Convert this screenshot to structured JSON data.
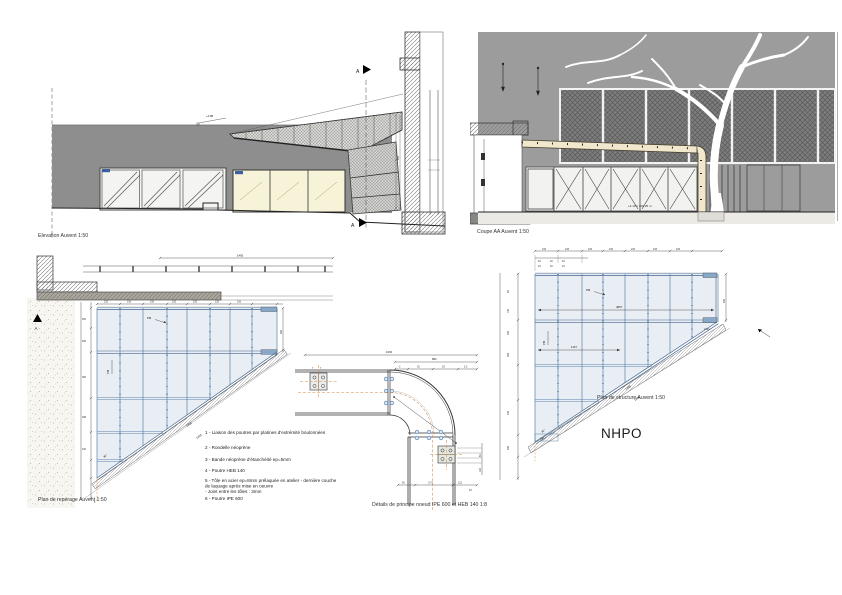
{
  "colors": {
    "facade_gray": "#8e8e8e",
    "section_gray": "#9c9c9c",
    "dark_panel": "#7d7d7d",
    "window_yellow": "#f7f3d9",
    "panel_blue": "#e9eef4",
    "beam_blue": "#5b82a8",
    "cap_blue": "#89a8c8",
    "beam_cream": "#f0e7cd",
    "centerline_tan": "#cf8a45",
    "line_dark": "#333333"
  },
  "elevation": {
    "caption": "Elevation Auvent 1:50",
    "section_marker": "A",
    "level_label": "+4.88",
    "dim_side": "940"
  },
  "coupe": {
    "caption": "Coupe AA Auvent 1:50",
    "level_label": "+4.10 = 109.25 m"
  },
  "plan_reperage": {
    "caption": "Plan de repérage Auvent 1:50",
    "section_marker": "A",
    "angle_label": "30°",
    "pm_label": "PM",
    "tip_label": "5",
    "dim_top_total": "1465",
    "dims_top": [
      "233",
      "233",
      "233",
      "233",
      "233",
      "233",
      "233"
    ],
    "dims_left": [
      "500",
      "455",
      "350",
      "298",
      "150"
    ],
    "dim_right": "500",
    "dims_hyp": [
      "1465",
      "1425"
    ]
  },
  "detail": {
    "caption": "Détails de principe noeud IPE 600 et HEB 140 1:8",
    "dim_top_total": "1060",
    "dim_top_right": "882",
    "dims_top_ticks": [
      "3",
      "25",
      "25",
      "5.2"
    ],
    "dims_plate": [
      "7",
      "7"
    ],
    "dims_bottom": [
      "60",
      "37.5",
      "122",
      "64"
    ],
    "dims_right": [
      "83",
      "164"
    ]
  },
  "plan_structure": {
    "caption": "Plan de structure Auvent 1:50",
    "brand": "NHPO",
    "angle_label": "30°",
    "pm_label": "PM",
    "dim_overall": "4867",
    "dim_partial": "1167",
    "dim_small": "140",
    "dim_corner": "2193",
    "dims_top": [
      "233",
      "233",
      "233",
      "233",
      "233",
      "233",
      "233"
    ],
    "dims_cluster": [
      "40",
      "40",
      "40",
      "40",
      "40",
      "40"
    ],
    "dims_left": [
      "50",
      "155",
      "303",
      "350",
      "455",
      "500"
    ],
    "dims_hyp": [
      "1465",
      "1425"
    ],
    "dim_right": "500"
  },
  "legend": {
    "lines": [
      "1 - Liaison des poutres par platines d'extrémité boulonnées",
      "2 - Rondelle néoprène",
      "3 - Bande néoprène d'étanchéité ep=5mm",
      "4 - Poutre HEB 140",
      "5 - Tôle en acier ep=8mm prélaquée en atelier - dernière couche",
      "de laquage après mise en oeuvre",
      " - Joint entre les tôles : 3mm",
      "6 - Poutre IPE 600"
    ]
  }
}
